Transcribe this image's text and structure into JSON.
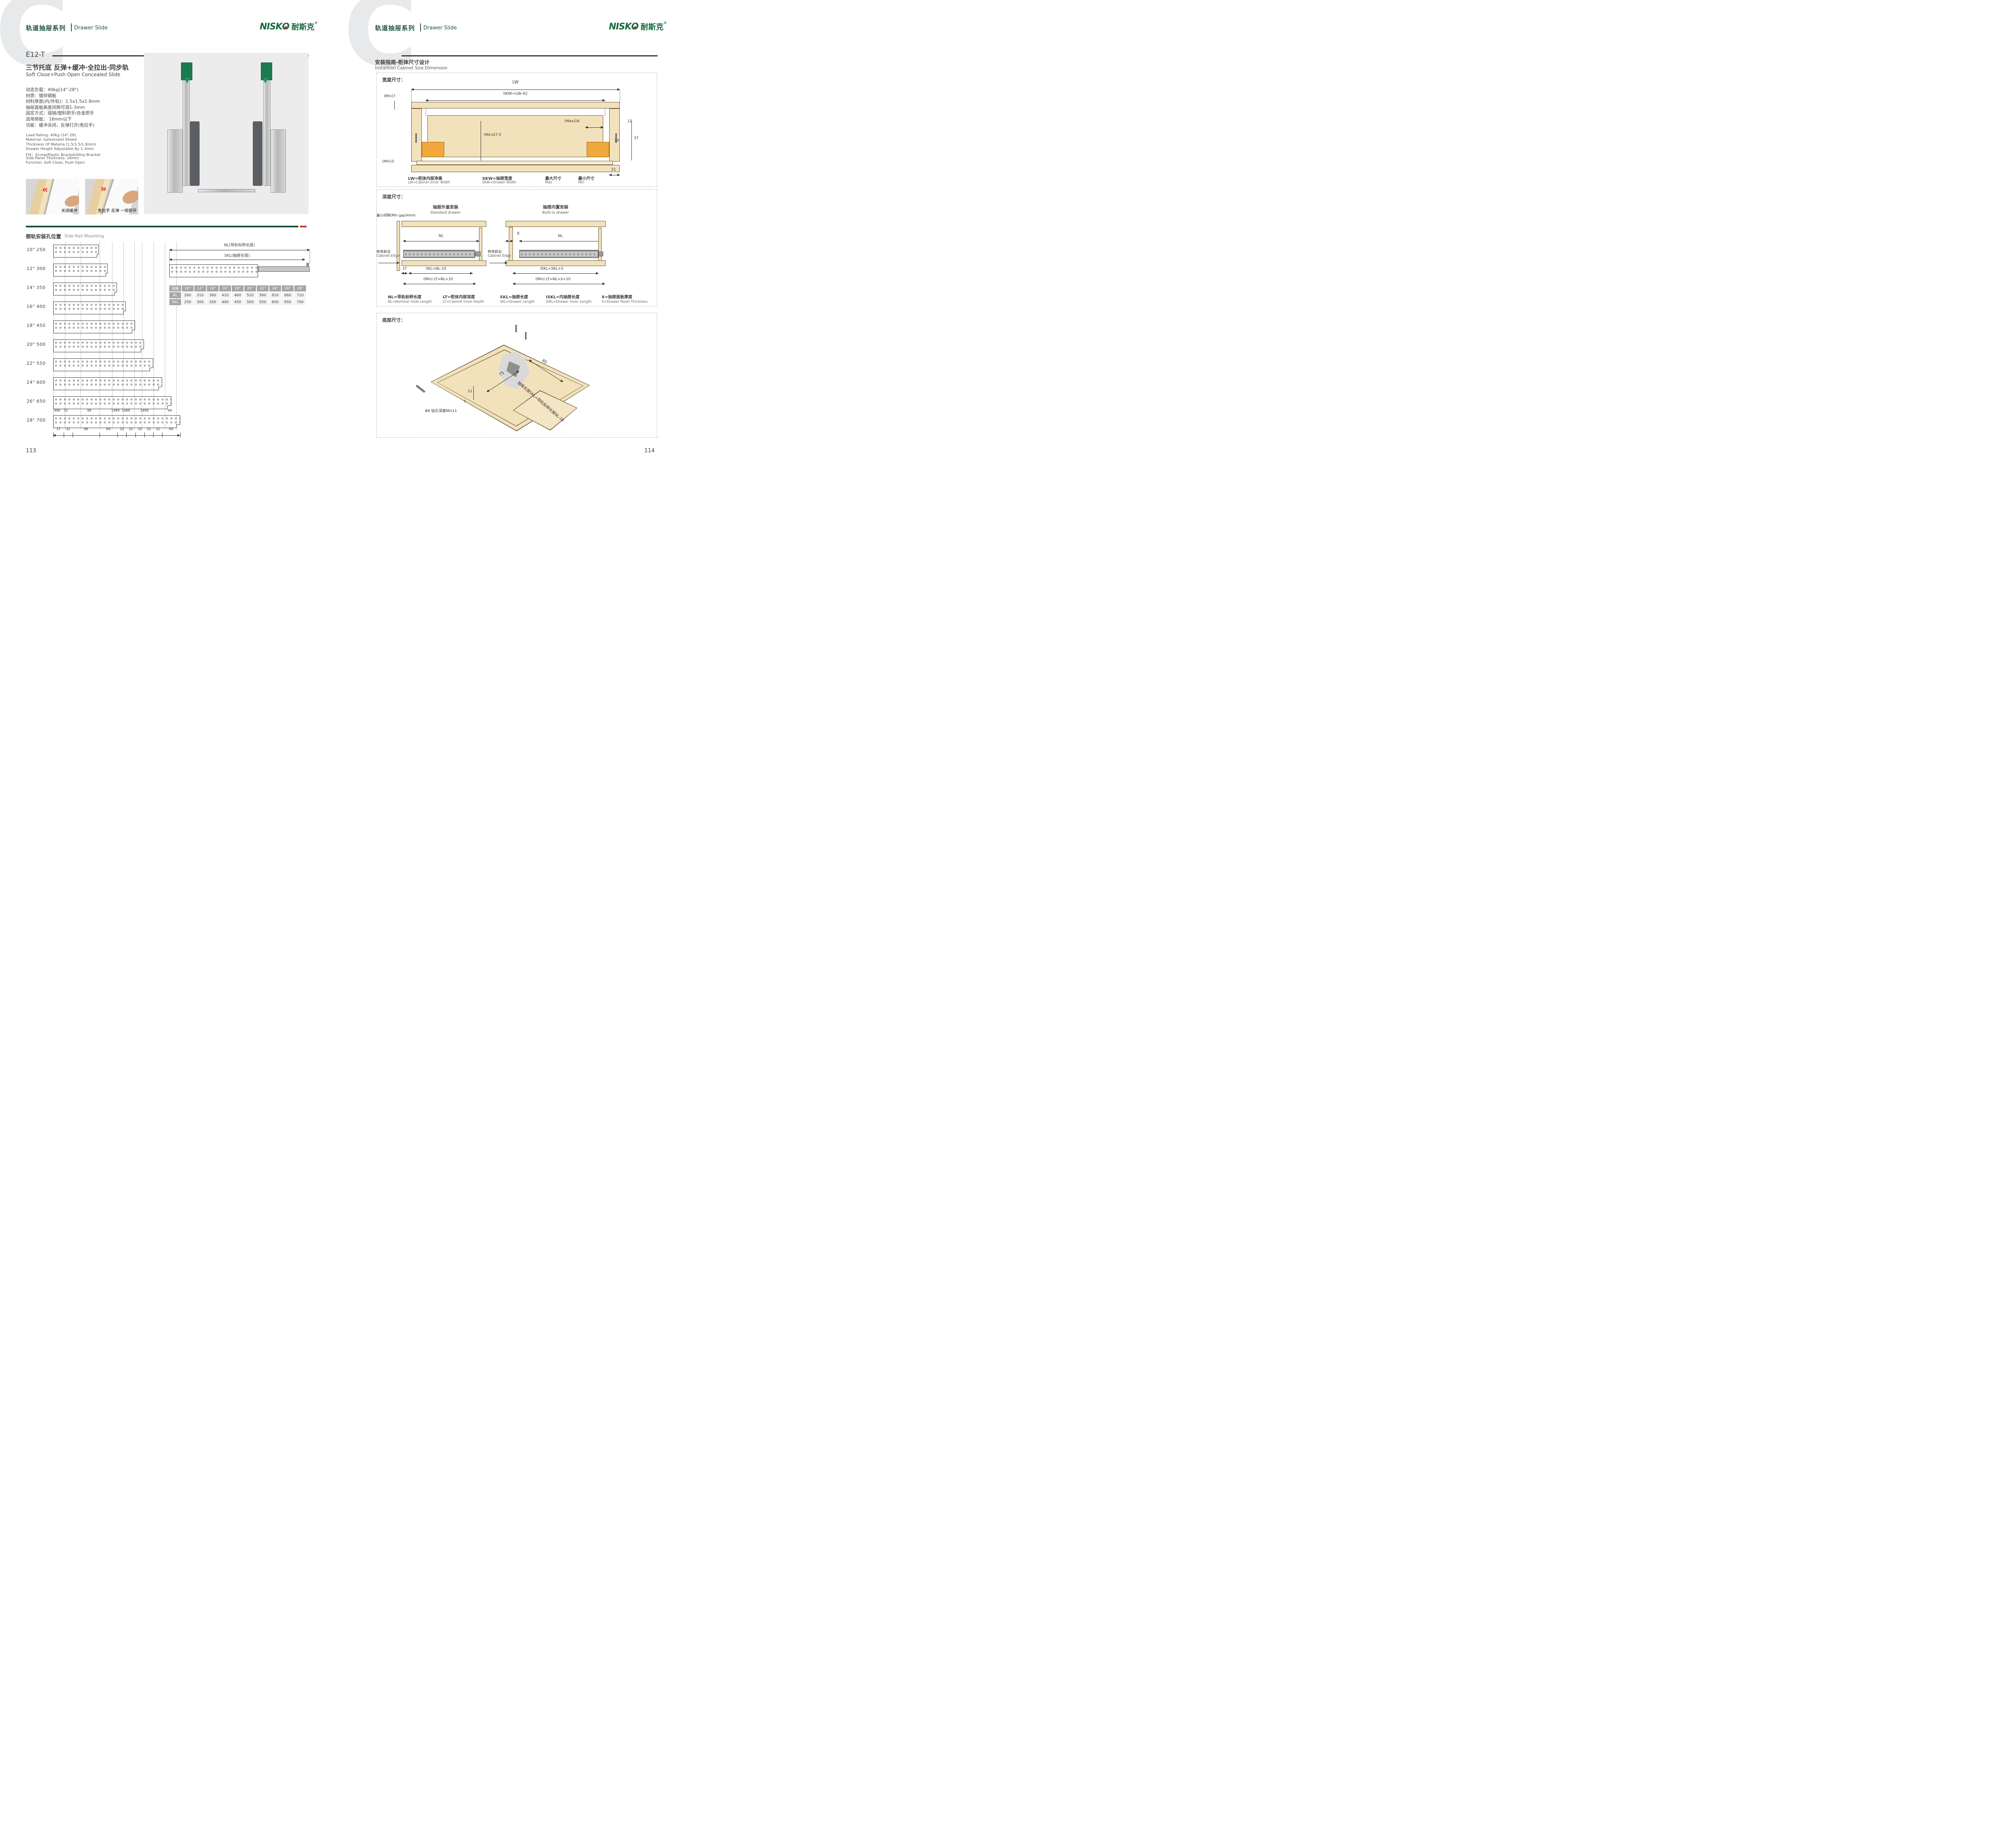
{
  "brand": {
    "logo_text_a": "NISK",
    "logo_text_o": "O",
    "logo_zh": "耐斯克",
    "reg": "®",
    "accent_green": "#1d5c45",
    "accent_red": "#bf2b2b"
  },
  "header": {
    "series_zh": "轨道抽屉系列",
    "series_en": "Drawer Slide",
    "watermark": "C"
  },
  "left_page": {
    "model": "E12-T",
    "subtitle_zh": "三节托底 反弹+缓冲·全拉出·同步轨",
    "subtitle_en": "Soft Close+Push Open Concealed Slide",
    "specs_zh": [
      "动态负载：40kg(14\"-28\")",
      "材质：镀锌钢板",
      "材料厚度(内/外轨)：1.5x1.5x1.8mm",
      "抽屉面板高度间隙可调1-3mm",
      "固定方式：插销/塑料把手/合金把手",
      "适用侧板： 16mm以下",
      "功能：缓冲关闭，反弹打开(免拉手)"
    ],
    "specs_en": [
      "Load Rating: 40kg (14\"-28)",
      "Material: Galvanized Sheed",
      "Thickness Of Materia (1.5/1.5/1.8mm)",
      "Drawer Height Adjustable By 1-3mm",
      "FIX：Screw/Plastic Bracket/Alloy Bracket",
      "Side Panel Thickness: 16mm",
      "Function: Soft Close, Push Open"
    ],
    "photo_captions": [
      "关闭缓冲",
      "免拉手 反弹 一按即开"
    ],
    "side_rail": {
      "title_zh": "侧轨安装孔位置",
      "title_en": "Side Rail Mounting",
      "rows": [
        {
          "inch": "10\"",
          "mm": 250
        },
        {
          "inch": "12\"",
          "mm": 300
        },
        {
          "inch": "14\"",
          "mm": 350
        },
        {
          "inch": "16\"",
          "mm": 400
        },
        {
          "inch": "18\"",
          "mm": 450
        },
        {
          "inch": "20\"",
          "mm": 500
        },
        {
          "inch": "22\"",
          "mm": 550
        },
        {
          "inch": "24\"",
          "mm": 600
        },
        {
          "inch": "26\"",
          "mm": 650
        },
        {
          "inch": "28\"",
          "mm": 700
        }
      ],
      "dims_between": [
        "999",
        "32",
        "99",
        "1499",
        "1499",
        "1499",
        "99"
      ],
      "dims_bottom": [
        "37",
        "32",
        "96",
        "64",
        "32",
        "32",
        "32",
        "32",
        "32",
        "64"
      ],
      "nl_dim_label": "NL(导轨标称长度)",
      "skl_dim_label": "SKL(抽屉长度)",
      "table": {
        "col0": "规格",
        "row_nl": "NL",
        "row_skl": "SKL",
        "sizes": [
          "10\"",
          "12\"",
          "14\"",
          "16\"",
          "18\"",
          "20\"",
          "22\"",
          "24\"",
          "26\"",
          "28\""
        ],
        "nl_values": [
          "260",
          "310",
          "360",
          "410",
          "460",
          "510",
          "560",
          "610",
          "660",
          "710"
        ],
        "skl_values": [
          "250",
          "300",
          "350",
          "400",
          "450",
          "500",
          "550",
          "600",
          "650",
          "700"
        ]
      }
    },
    "page_number": "113"
  },
  "right_page": {
    "section_title_zh": "安装指南-柜体尺寸设计",
    "section_title_en": "Installtion Cabinet Size Dimension",
    "width_box": {
      "label": "宽度尺寸：",
      "dims": {
        "lw": "LW",
        "skw": "SKW=LW-42",
        "min7": "(Min)7",
        "max16": "(Max)16",
        "d12": "12",
        "d10": "10",
        "d37": "37",
        "min275": "(Min)27.5",
        "min3": "(Min)3",
        "d21": "21"
      },
      "legend": [
        {
          "zh": "LW=柜体内部净高",
          "en": "LW=Cabinet Inner Width"
        },
        {
          "zh": "SKW=抽屉宽度",
          "en": "SKW=Drawer  Width"
        },
        {
          "zh": "最大尺寸",
          "en": "Max"
        },
        {
          "zh": "最小尺寸",
          "en": "Min"
        }
      ]
    },
    "depth_box": {
      "label": "深度尺寸：",
      "min_gap": "最小间隙(Min gap)4mm",
      "standard": {
        "title_zh": "抽屉外盖安装",
        "title_en": "Standard drawer",
        "nl": "NL",
        "d37": "37",
        "skl": "SKL=NL-10",
        "lt": "(Min) LT=NL+10",
        "edge_zh": "柜体前沿",
        "edge_en": "Cabinet Edge"
      },
      "builtin": {
        "title_zh": "抽屉内置安装",
        "title_en": "Built-in drawer",
        "x": "X",
        "nl": "NL",
        "iskl": "ISKL=SKL+X",
        "lt": "(Min) LT=NL+X+10",
        "edge_zh": "柜体前沿",
        "edge_en": "Cabinet Edge"
      },
      "legend": [
        {
          "zh": "NL=导轨标称长度",
          "en": "NL=Nominal Slide Length"
        },
        {
          "zh": "LT=柜体内部深度",
          "en": "LT=Cabinet Inner Depth"
        },
        {
          "zh": "SKL=抽屉长度",
          "en": "SKL=Drawer Length"
        },
        {
          "zh": "ISKL=内抽屉长度",
          "en": "ISKL=Drawer Inner Length"
        },
        {
          "zh": "X=抽屉面板厚度",
          "en": "X=Drawer Panel Thickness"
        }
      ]
    },
    "bottom_box": {
      "label": "底部尺寸：",
      "d75": "75",
      "d85": "85",
      "d11": "11",
      "d7": "7",
      "drill": "Φ6 钻孔深度Min11",
      "skl_note": "抽屉长度SKL=导轨标称长度NL-10"
    },
    "page_number": "114"
  }
}
